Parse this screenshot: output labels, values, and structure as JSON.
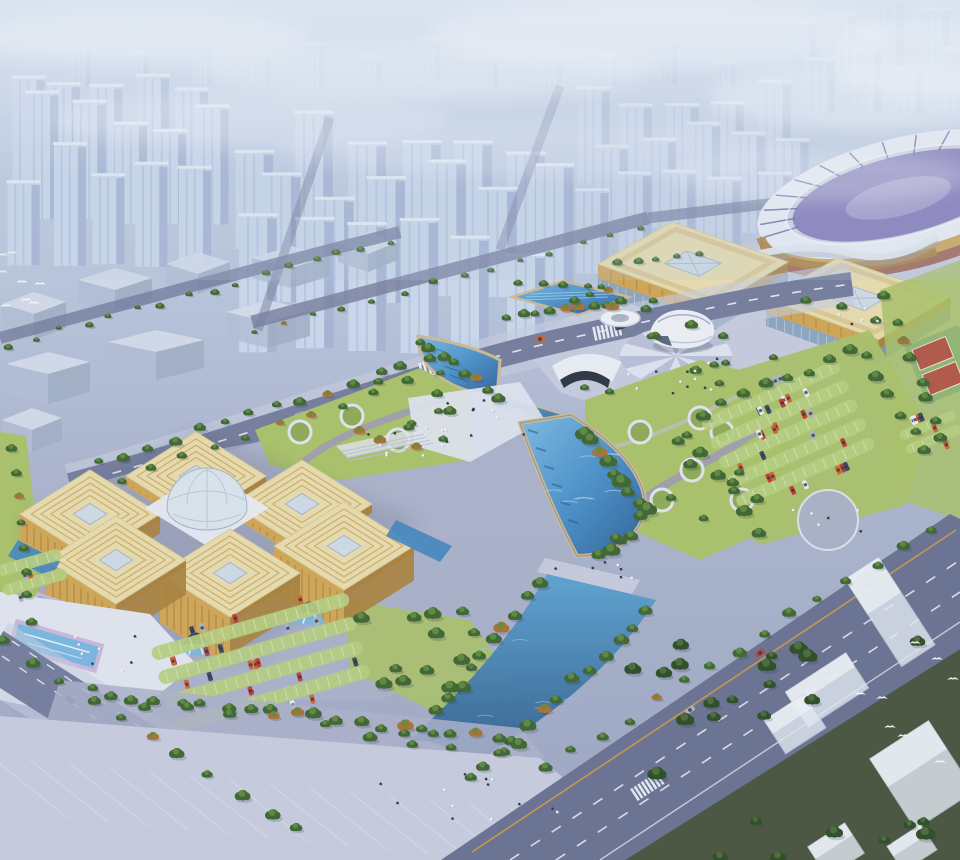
{
  "scene": {
    "kind": "aerial-architectural-rendering",
    "landmarks": {
      "city_skyline": "hazy high-rise residential towers",
      "industrial_blocks": "translucent low warehouse blocks",
      "stadium": "oval stadium with gold facade and purple bowl",
      "conference_hall_east": "gold-roofed exhibition hall",
      "conference_hall_south": "gold-roofed exhibition hall",
      "egg_sculpture": "white egg-shaped pavilion on sunburst plaza",
      "exhibition_center": "six gold cubes around faceted glass dome",
      "north_pool": "rectangular reflecting pool",
      "crescent_pool": "sail-shaped pool with underpass",
      "crescent_lake": "fan-shaped blue lake",
      "south_canal": "tree-lined canal",
      "parking_lots": "green-striped lots with cars",
      "sports_courts": "red courts",
      "forest_strip": "dark tree belt with white blocks",
      "birds": "white birds in flight"
    }
  },
  "colors": {
    "tower": "#ccd8ec",
    "towerShade": "#a4b3d1",
    "towerStripe": "#b7c5e0",
    "towerCap": "#e9eff8",
    "fog": "#edf2f9",
    "whTop": "#d4dce9",
    "whSide": "#b0bcd2",
    "road": "#737b9b",
    "roadDark": "#676f8e",
    "lane": "#eef1f8",
    "yellow": "#d09a3e",
    "plazaL": "#c6cbdd",
    "plazaM": "#a9afc8",
    "plazaW": "#e0e3ee",
    "pathP": "#9a92bf",
    "lawn": "#a8bf66",
    "lawnL": "#c4d38a",
    "lawnD": "#8ca853",
    "tree": "#3c632f",
    "treeD": "#294a21",
    "treeL": "#5d8a3a",
    "autumn": "#a86e30",
    "water": "#3f83bc",
    "waterD": "#2a5f96",
    "waterL": "#79b4dd",
    "waterP": "#a9d2ec",
    "sand": "#cbb891",
    "deckP": "#c9b6d8",
    "roofC": "#e7dbac",
    "roofS": "#c8a75a",
    "gold": "#cfa452",
    "goldD": "#a87f3a",
    "glass": "#8ba3bc",
    "glassL": "#cdd8e4",
    "white": "#f2f4f9",
    "stadPur": "#8478b8",
    "stadPurD": "#5f5694",
    "stadBase": "#9c5a48",
    "courtR": "#b05545",
    "courtG": "#7fae6a",
    "lotG": "#b5cc7e",
    "carR": "#c23b2a",
    "carO": "#d2622a",
    "carD": "#3a4560",
    "carS": "#aab3c4",
    "carW": "#e8eaf0",
    "bird": "#f8fafc",
    "forest": "#46523b",
    "ink": "#273046"
  }
}
